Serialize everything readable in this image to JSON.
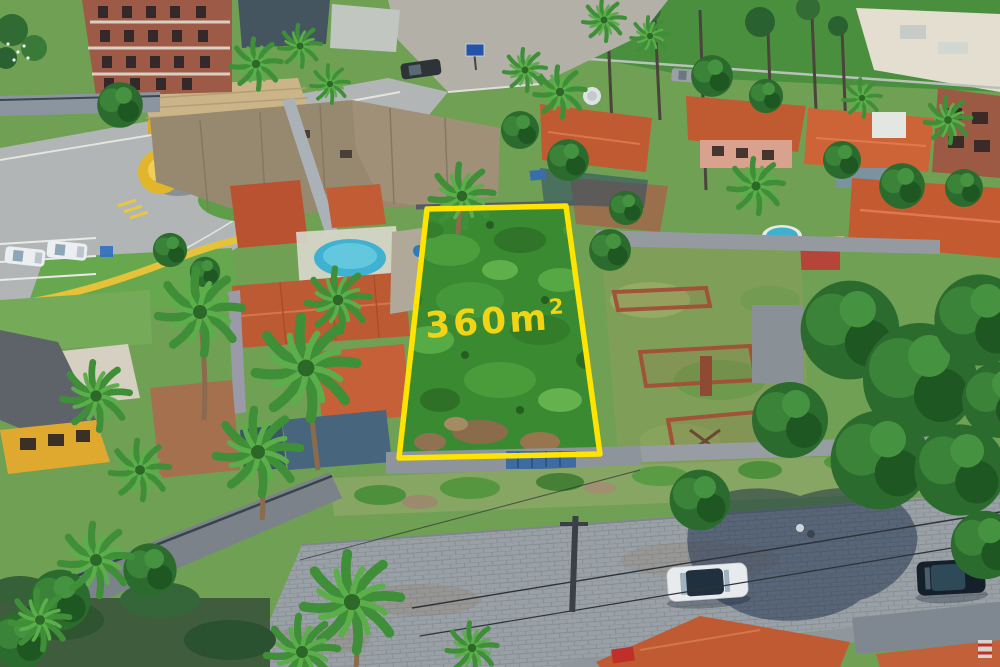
{
  "photo": {
    "kind": "aerial-drone-photograph",
    "visible_text": "360m²"
  },
  "overlay": {
    "area_value": "360m",
    "area_exponent": "2",
    "area_label_full": "360m²",
    "outline_color": "#FFE400",
    "label_color": "#F2D417"
  },
  "palette": {
    "street_gray": "#b3b0a8",
    "cobblestone_gray": "#9aa1a6",
    "lot_green": "#3a8a31",
    "terracotta_roof": "#c05a32",
    "weathered_roof": "#97896f",
    "condo_yellow": "#e2b62c",
    "pool_blue": "#3fb2d2",
    "tree_dark_green": "#2b6b2d",
    "shadow_blue": "#102442",
    "brick_red": "#9d5a46"
  },
  "scene": {
    "featured_lot": {
      "boundary": "yellow outline",
      "ground": "overgrown green vegetation with dirt patches",
      "area_label": "360m²"
    },
    "landmarks": [
      "condominium entrance with tan canopy and round yellow guard kiosk",
      "unfinished brick apartment building",
      "terracotta-roof houses",
      "two swimming pools",
      "sports field top right",
      "vacant lot with brick foundation ruins",
      "cobblestone street with parked white car and dark SUV",
      "palm trees and dense tropical trees"
    ]
  }
}
